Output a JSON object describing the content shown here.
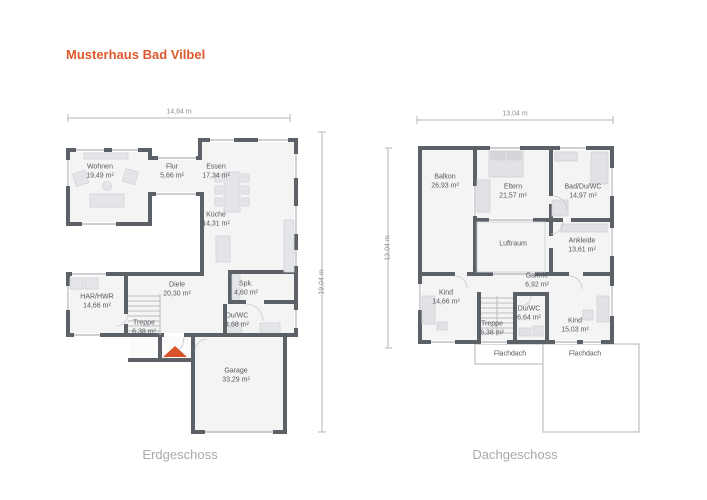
{
  "title": "Musterhaus Bad Vilbel",
  "colors": {
    "accent": "#dd5a2e",
    "north_arrow": "#d8542a",
    "wall": "#5c6167",
    "room_fill": "#f4f4f5",
    "furniture": "#e4e5e8",
    "caption_text": "#a9a9a9",
    "label_text": "#55585c"
  },
  "plans": [
    {
      "caption": "Erdgeschoss",
      "dim_width": "14,84 m",
      "dim_height": "19,04 m",
      "rooms": [
        {
          "label": "Wohnen",
          "area": "19,49 m²"
        },
        {
          "label": "Flur",
          "area": "5,66 m²"
        },
        {
          "label": "Essen",
          "area": "17,34 m²"
        },
        {
          "label": "Küche",
          "area": "14,31 m²"
        },
        {
          "label": "HAR/HWR",
          "area": "14,66 m²"
        },
        {
          "label": "Diele",
          "area": "20,30 m²"
        },
        {
          "label": "Treppe",
          "area": "6,38 m²"
        },
        {
          "label": "Spk.",
          "area": "4,60 m²"
        },
        {
          "label": "Du/WC",
          "area": "4,68 m²"
        },
        {
          "label": "Garage",
          "area": "33,29 m²"
        }
      ]
    },
    {
      "caption": "Dachgeschoss",
      "dim_width": "13,04 m",
      "dim_height": "13,04 m",
      "rooms": [
        {
          "label": "Balkon",
          "area": "26,93 m²"
        },
        {
          "label": "Eltern",
          "area": "21,57 m²"
        },
        {
          "label": "Bad/Du/WC",
          "area": "14,97 m²"
        },
        {
          "label": "Luftraum",
          "area": ""
        },
        {
          "label": "Ankleide",
          "area": "13,61 m²"
        },
        {
          "label": "Galerie",
          "area": "6,92 m²"
        },
        {
          "label": "Kind",
          "area": "14,66 m²"
        },
        {
          "label": "Du/WC",
          "area": "6,64 m²"
        },
        {
          "label": "Treppe",
          "area": "6,38 m²"
        },
        {
          "label": "Kind",
          "area": "15,03 m²"
        },
        {
          "label": "Flachdach",
          "area": ""
        },
        {
          "label": "Flachdach",
          "area": ""
        }
      ]
    }
  ]
}
